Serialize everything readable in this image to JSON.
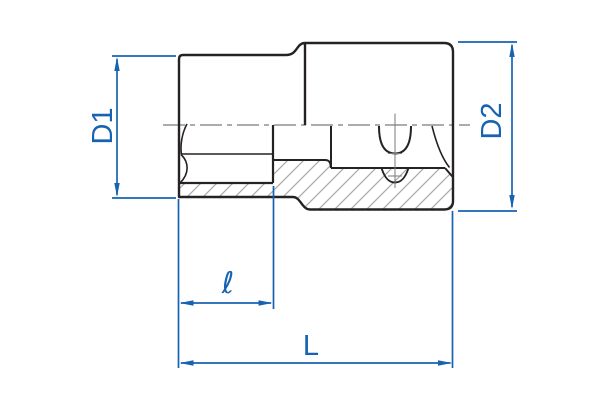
{
  "diagram": {
    "type": "technical-drawing",
    "subject": "socket half-section with dimensions",
    "labels": {
      "d1": "D1",
      "d2": "D2",
      "ell": "ℓ",
      "length": "L"
    },
    "colors": {
      "dimension_blue": "#1763b3",
      "outline_black": "#262223",
      "hatch_gray": "#a9a9a9",
      "centerline_gray": "#7a7a7a",
      "background": "#ffffff"
    }
  }
}
